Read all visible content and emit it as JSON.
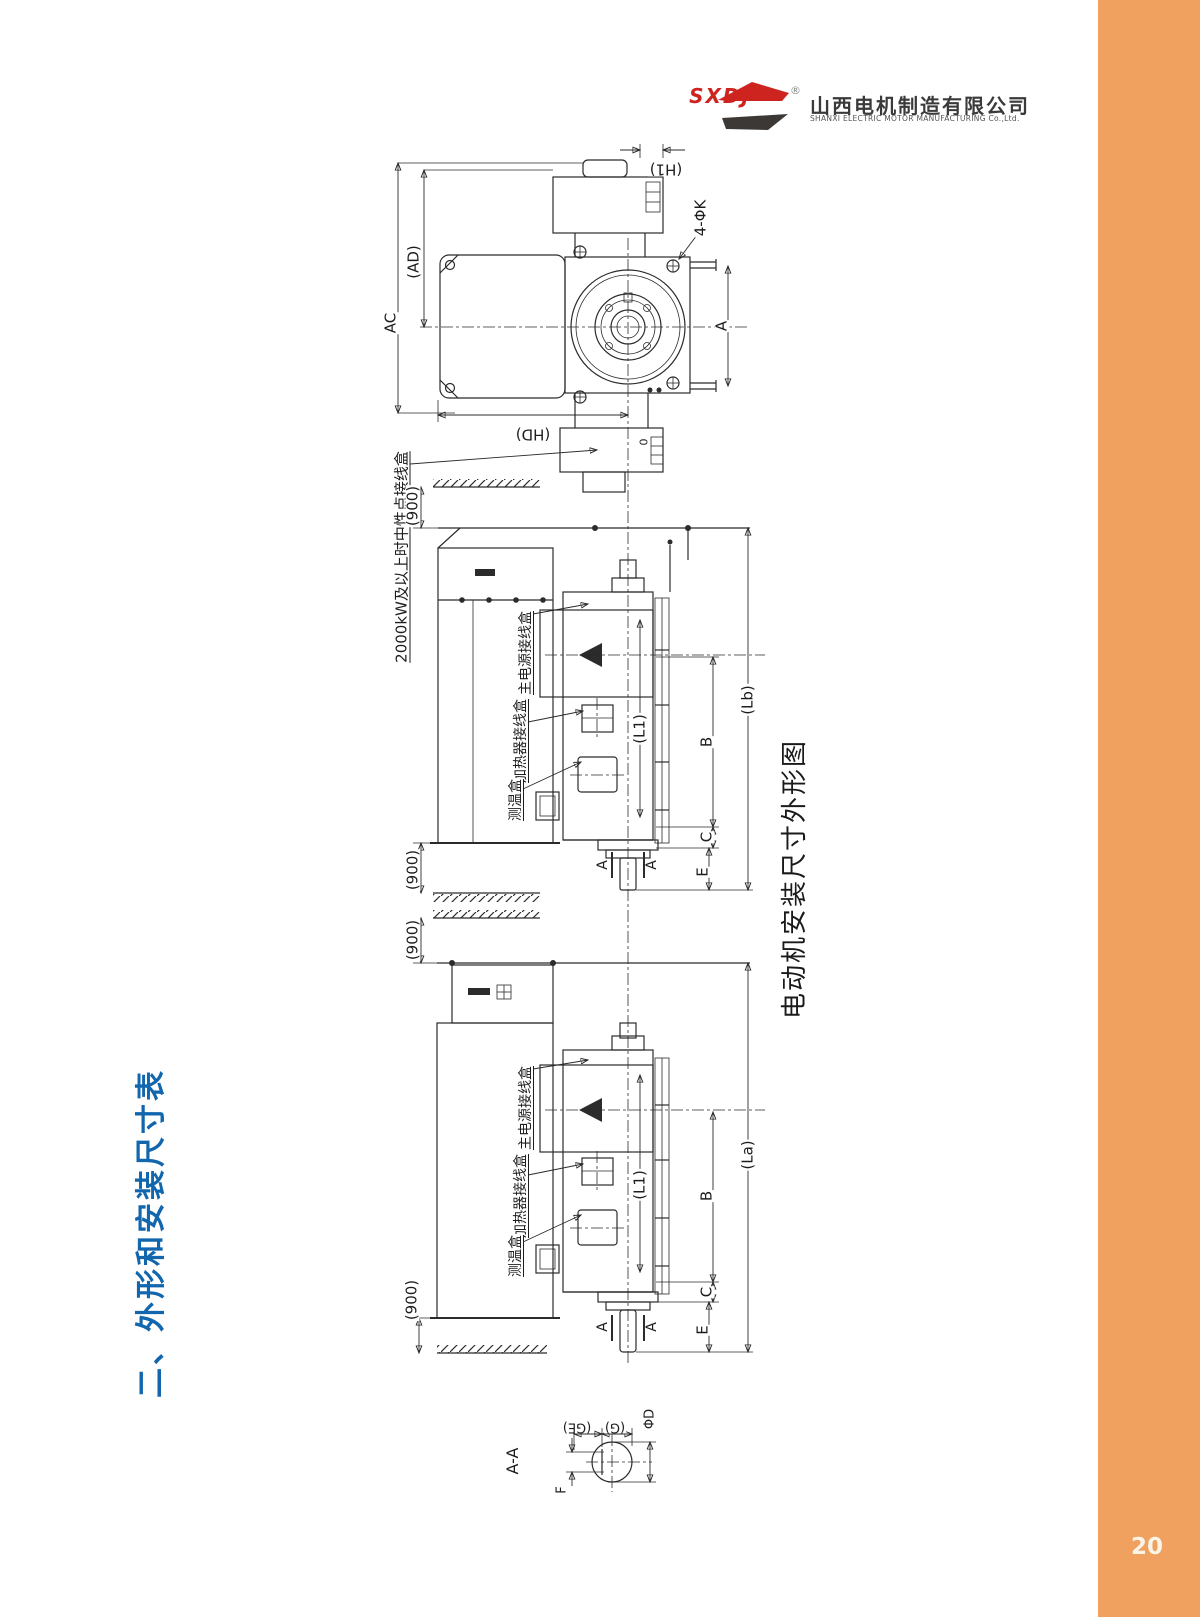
{
  "page": {
    "number": "20"
  },
  "header": {
    "logo_abbr": "SXDJ",
    "registered_mark": "®",
    "company_cn": "山西电机制造有限公司",
    "company_en": "SHANXI ELECTRIC MOTOR MANUFACTURING Co.,Ltd."
  },
  "section_title": "二、外形和安装尺寸表",
  "figure_caption": "电动机安装尺寸外形图",
  "note": {
    "neutral_box": "2000kW及以上时中性点接线盒"
  },
  "labels": {
    "d1": {
      "h1": "(H1)",
      "holes": "4-ΦK",
      "ad": "(AD)",
      "ac": "AC",
      "a": "A",
      "hd": "(HD)",
      "zero": "0"
    },
    "d2": {
      "dim900_top": "(900)",
      "dim900_bottom": "(900)",
      "main_box": "主电源接线盒",
      "heater_box": "加热器接线盒",
      "temp_box": "测温盒",
      "l1": "(L1)",
      "b": "B",
      "c": "C",
      "e": "E",
      "lb": "(Lb)",
      "sec_a_left": "A",
      "sec_a_right": "A"
    },
    "d3": {
      "dim900_top": "(900)",
      "dim900_bottom": "(900)",
      "main_box": "主电源接线盒",
      "heater_box": "加热器接线盒",
      "temp_box": "测温盒",
      "l1": "(L1)",
      "b": "B",
      "c": "C",
      "e": "E",
      "la": "(La)",
      "sec_a_left": "A",
      "sec_a_right": "A"
    },
    "section": {
      "title": "A-A",
      "ge": "(GE)",
      "g": "(G)",
      "phi_d": "ΦD",
      "f": "F"
    }
  },
  "colors": {
    "accent_orange": "#F0A05F",
    "title_blue": "#1166AE",
    "logo_red": "#CE2420",
    "line": "#2b2b2b"
  }
}
